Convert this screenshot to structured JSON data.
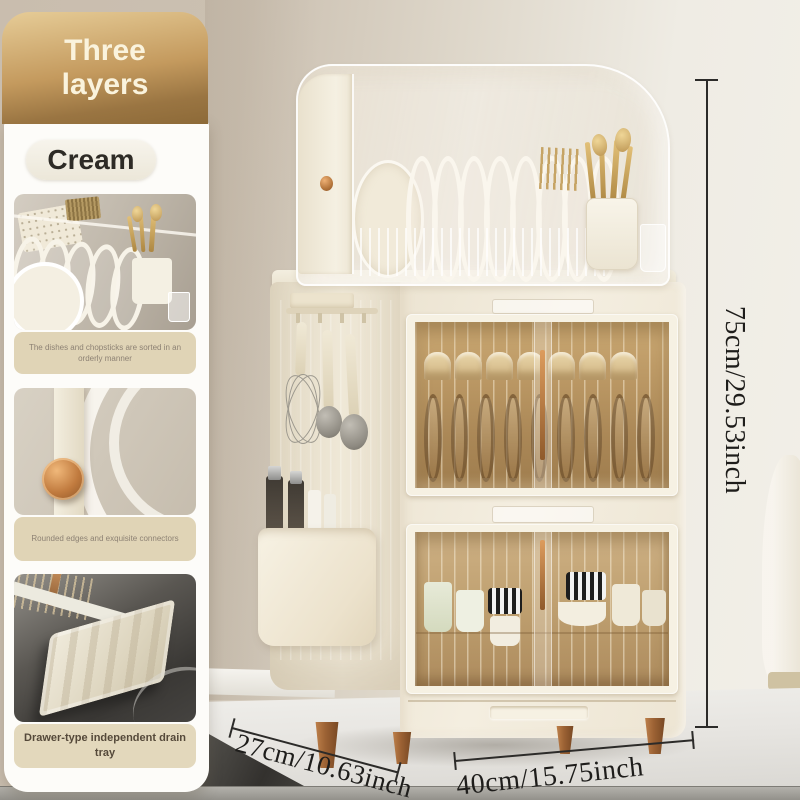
{
  "badge": {
    "line1": "Three",
    "line2": "layers"
  },
  "color_label": "Cream",
  "features": [
    {
      "caption": "The dishes and chopsticks are sorted in an orderly manner"
    },
    {
      "caption": "Rounded edges and exquisite connectors"
    },
    {
      "caption": "Drawer-type independent drain tray"
    }
  ],
  "dimensions": {
    "height": {
      "label": "75cm/29.53inch"
    },
    "depth": {
      "label": "27cm/10.63inch"
    },
    "width": {
      "label": "40cm/15.75inch"
    }
  },
  "colors": {
    "badge_gradient_top": "#e6cc97",
    "badge_gradient_bottom": "#8d6a38",
    "cabinet_cream": "#efe8d7",
    "amber_glass": "#b5905c",
    "copper_accent": "#a5683c",
    "caption_background": "#e0d4b6"
  }
}
